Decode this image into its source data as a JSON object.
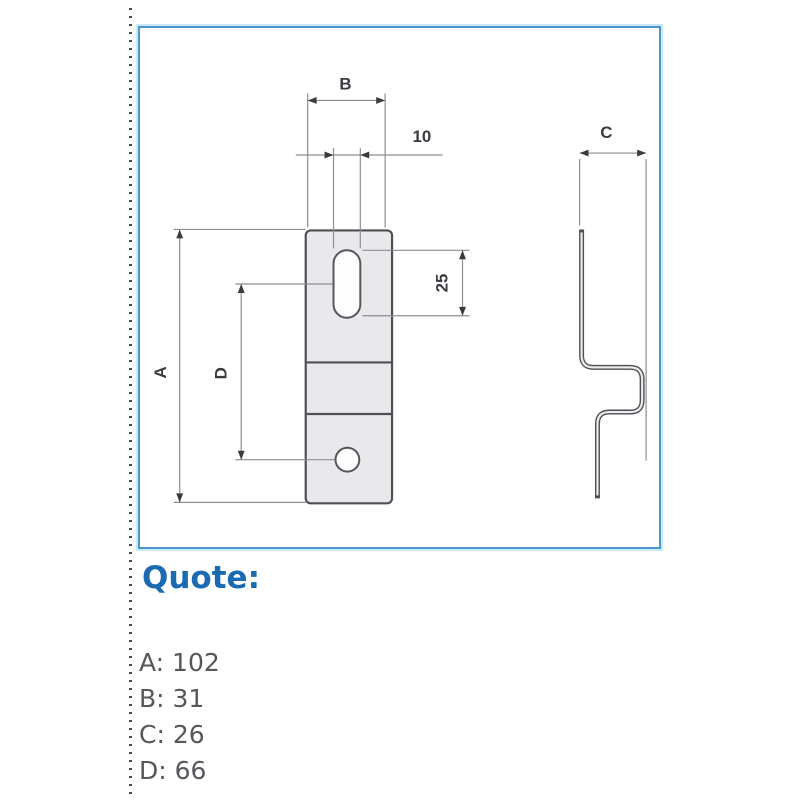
{
  "diagram": {
    "labels": {
      "height": "A",
      "width_top": "B",
      "side_depth": "C",
      "hole_spacing": "D",
      "slot_width": "10",
      "slot_length": "25"
    }
  },
  "quote": {
    "title": "Quote:",
    "separator": ": ",
    "dimensions": [
      {
        "label": "A",
        "value": "102"
      },
      {
        "label": "B",
        "value": "31"
      },
      {
        "label": "C",
        "value": "26"
      },
      {
        "label": "D",
        "value": "66"
      }
    ]
  },
  "colors": {
    "panel_border": "#4e95cb",
    "panel_halo": "#c9e8f8",
    "quote_title": "#1b6bb3",
    "list_text": "#56575c",
    "part_outline": "#4e4e55",
    "part_fill": "#e9e9ec",
    "dimension_line": "#8d8d92"
  }
}
